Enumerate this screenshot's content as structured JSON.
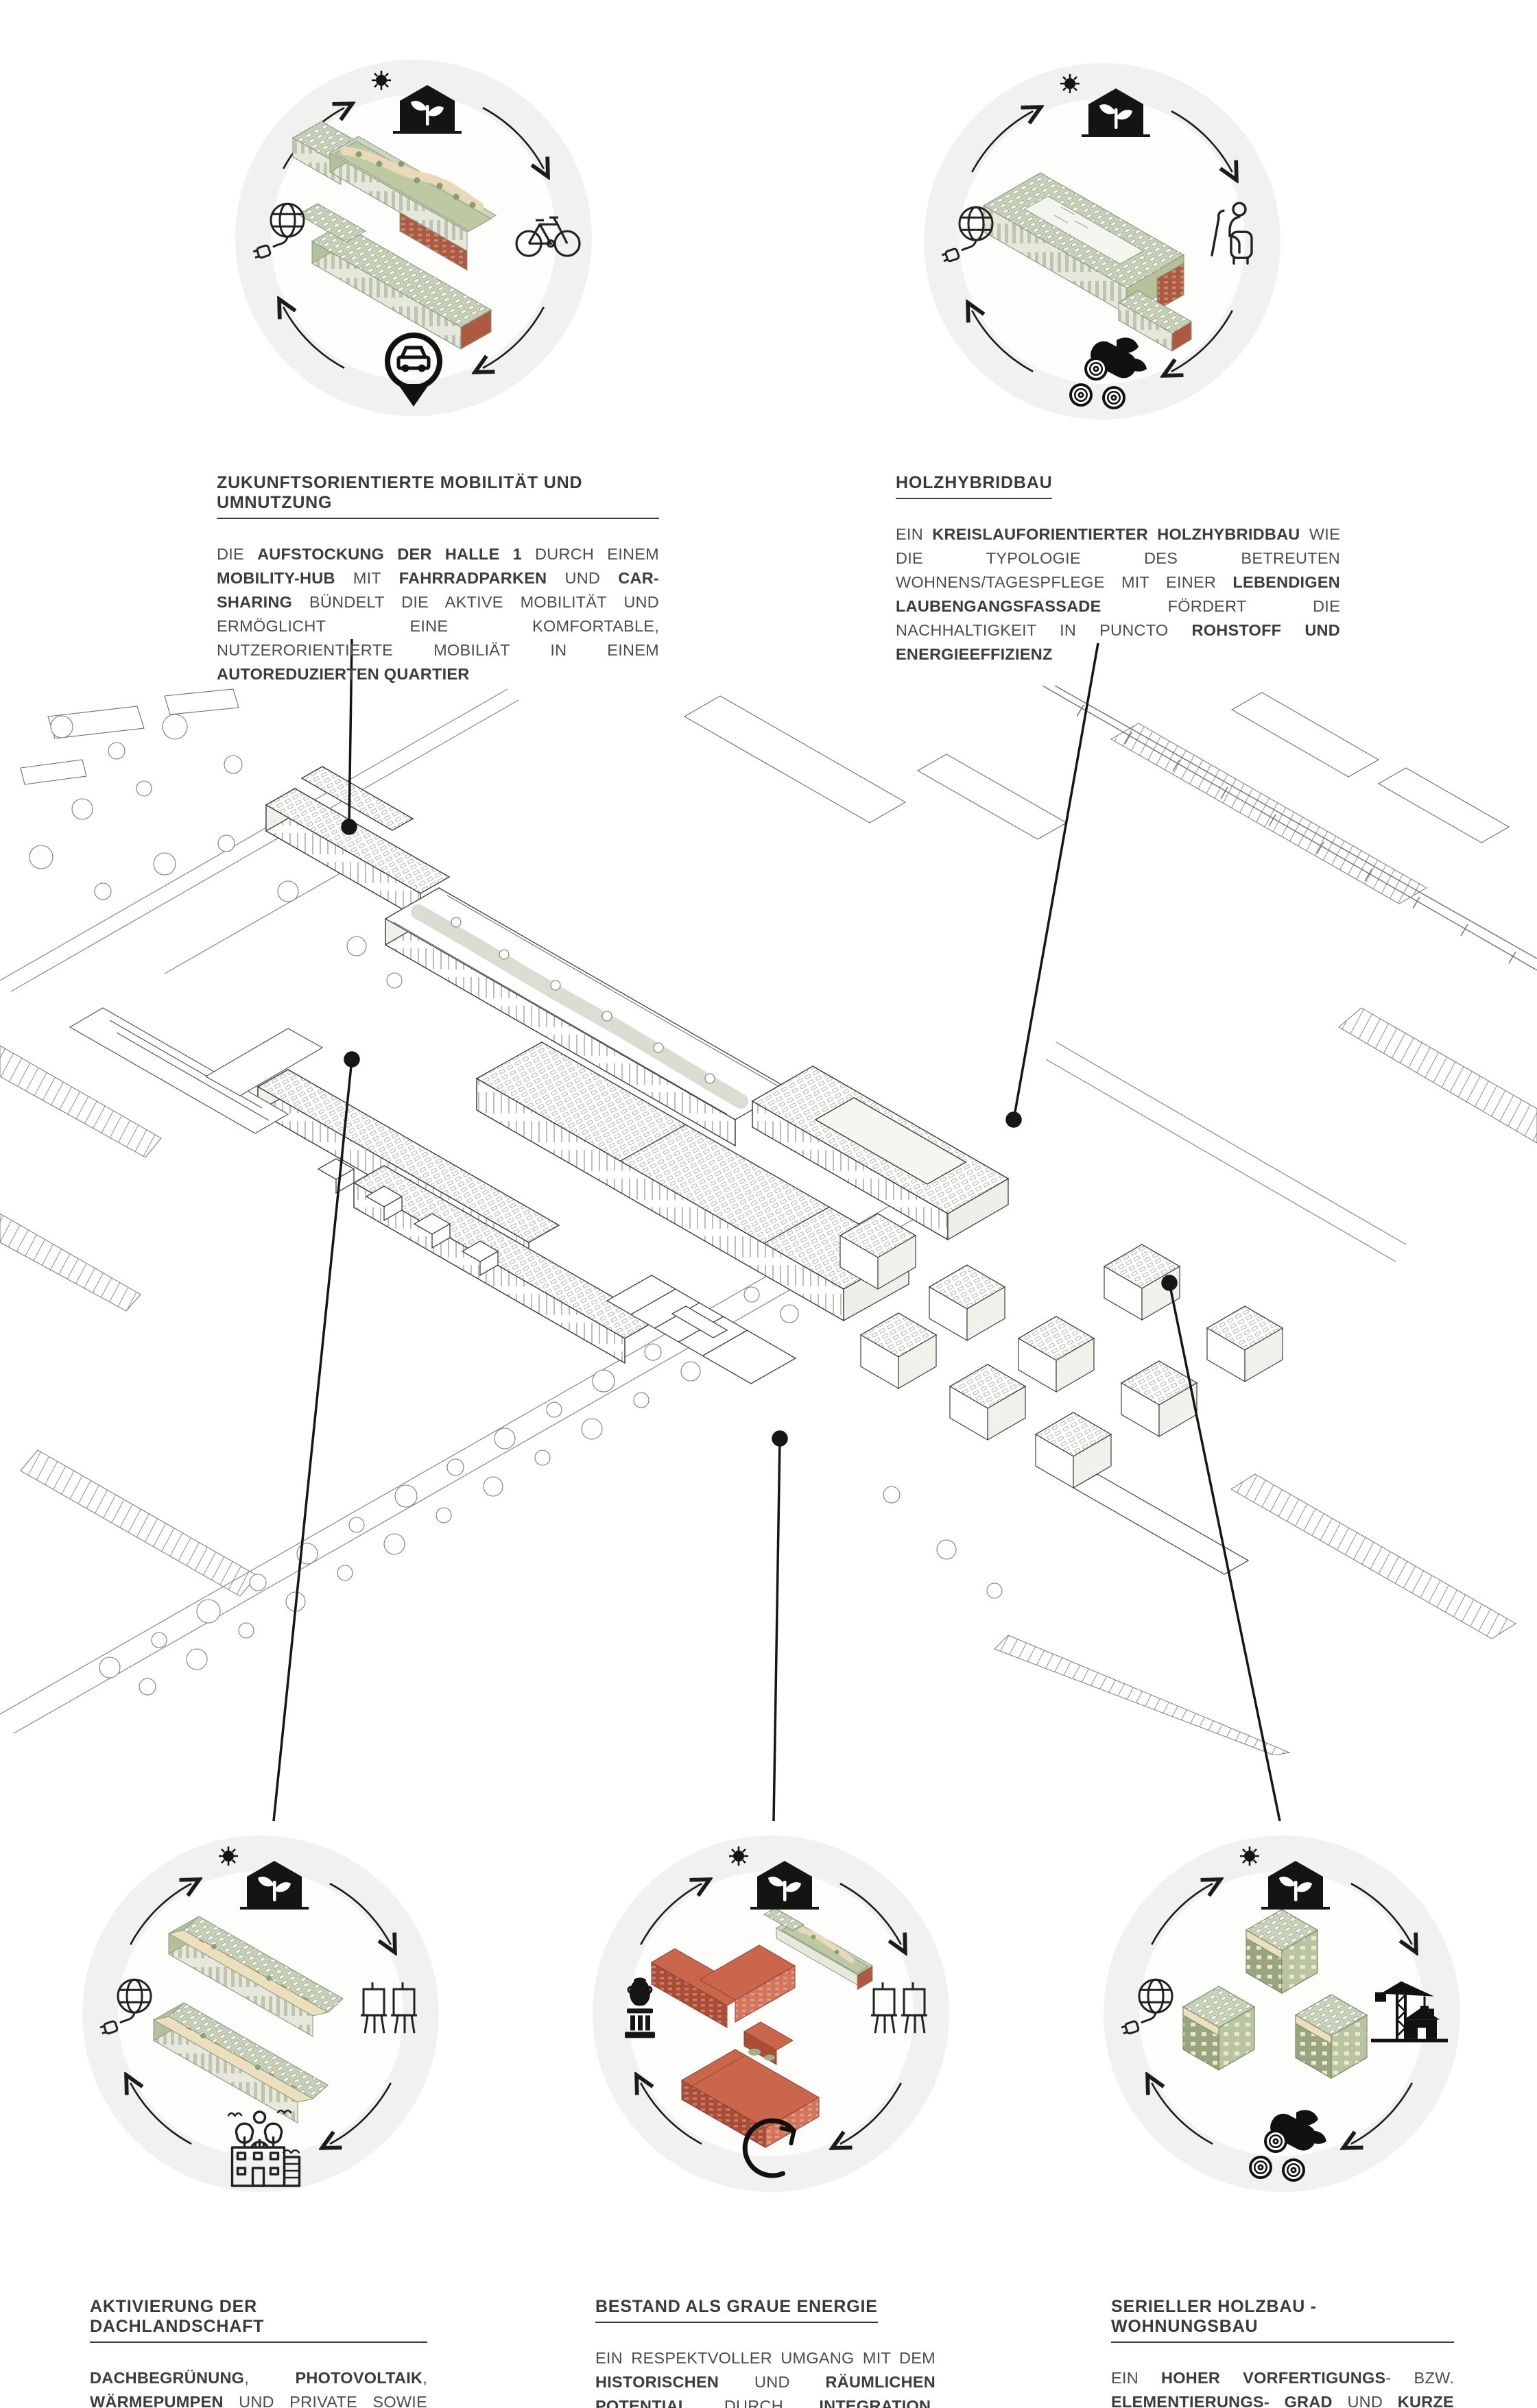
{
  "poster": {
    "colors": {
      "circle_background": "#f1f1ef",
      "line_black": "#1b1b1b",
      "pv_roof_green": "#c6d1b7",
      "landscape_roof_green": "#bcc9a3",
      "sand_path": "#ead9b9",
      "brick_red": "#ad5a41",
      "existing_building_red": "#c9664b",
      "wall_cream": "#e7e8dc",
      "text_gray": "#4c4c4c"
    },
    "sections": [
      {
        "id": "mobility",
        "title": "ZUKUNFTSORIENTIERTE MOBILITÄT UND UMNUTZUNG",
        "body": [
          {
            "t": "DIE "
          },
          {
            "t": "AUFSTOCKUNG DER HALLE 1",
            "b": true
          },
          {
            "t": " DURCH EINEM "
          },
          {
            "t": "MOBILITY-HUB",
            "b": true
          },
          {
            "t": " MIT "
          },
          {
            "t": "FAHRRADPARKEN",
            "b": true
          },
          {
            "t": " UND "
          },
          {
            "t": "CAR-SHARING",
            "b": true
          },
          {
            "t": " BÜNDELT DIE AKTIVE MOBILITÄT UND ERMÖGLICHT  EINE KOMFORTABLE, NUTZERORIENTIERTE MOBILIÄT IN EINEM "
          },
          {
            "t": "AUTOREDUZIERTEN  QUARTIER",
            "b": true
          }
        ],
        "icons": {
          "top": "eco-house-sun-icon",
          "left": "globe-plug-icon",
          "right": "bicycle-icon",
          "bottom": "car-sharing-pin-icon"
        },
        "illustration": "mobility-hub-halle1-axon"
      },
      {
        "id": "holzhybrid",
        "title": "HOLZHYBRIDBAU",
        "body": [
          {
            "t": "EIN "
          },
          {
            "t": "KREISLAUFORIENTIERTER  HOLZHYBRIDBAU",
            "b": true
          },
          {
            "t": "  WIE DIE TYPOLOGIE DES BETREUTEN WOHNENS/TAGESPFLEGE MIT EINER "
          },
          {
            "t": "LEBENDIGEN LAUBENGANGSFASSADE",
            "b": true
          },
          {
            "t": " FÖRDERT DIE NACHHALTIGKEIT IN PUNCTO "
          },
          {
            "t": "ROHSTOFF UND ENERGIEEFFIZIENZ",
            "b": true
          }
        ],
        "icons": {
          "top": "eco-house-sun-icon",
          "left": "globe-plug-icon",
          "right": "assisted-living-icon",
          "bottom": "timber-logs-icon"
        },
        "illustration": "holzhybrid-courtyard-axon"
      },
      {
        "id": "dachlandschaft",
        "title": "AKTIVIERUNG DER DACHLANDSCHAFT",
        "body": [
          {
            "t": "DACHBEGRÜNUNG",
            "b": true
          },
          {
            "t": ", "
          },
          {
            "t": "PHOTOVOLTAIK",
            "b": true
          },
          {
            "t": ", "
          },
          {
            "t": "WÄRMEPUMPEN",
            "b": true
          },
          {
            "t": " UND PRIVATE SOWIE GEMEINSCHAFTS"
          },
          {
            "t": "TERRASSEN",
            "b": true
          },
          {
            "t": " SORGEN FÜR EINE EFFIZIENTE DACHNUTZUNG, "
          },
          {
            "t": "ENERGIEGEWINNUNG",
            "b": true
          },
          {
            "t": " UND DESSEN "
          },
          {
            "t": "VERWERTUNG",
            "b": true
          }
        ],
        "icons": {
          "top": "eco-house-sun-icon",
          "left": "globe-plug-icon",
          "right": "heat-pump-icon",
          "bottom": "green-roof-community-icon"
        },
        "illustration": "roofscape-bars-axon"
      },
      {
        "id": "bestand",
        "title": "BESTAND ALS GRAUE ENERGIE",
        "body": [
          {
            "t": "EIN RESPEKTVOLLER UMGANG MIT DEM "
          },
          {
            "t": "HISTORISCHEN",
            "b": true
          },
          {
            "t": " UND "
          },
          {
            "t": "RÄUMLICHEN POTENTIAL",
            "b": true
          },
          {
            "t": " DURCH "
          },
          {
            "t": "INTEGRATION",
            "b": true
          },
          {
            "t": ", "
          },
          {
            "t": "ERHALT",
            "b": true
          },
          {
            "t": ", "
          },
          {
            "t": "WEITERBAU",
            "b": true
          },
          {
            "t": " UND "
          },
          {
            "t": "UMNUTZUNG",
            "b": true
          },
          {
            "t": " DES BESTANDES FORMT EINE SYMBIOSE MIT DEM "
          },
          {
            "t": "GENIUS LOCI",
            "b": true
          }
        ],
        "icons": {
          "top": "eco-house-sun-icon",
          "left": "historic-artifact-icon",
          "right": "heat-pump-icon",
          "bottom": "circularity-arrows-icon"
        },
        "illustration": "existing-red-buildings-axon"
      },
      {
        "id": "holzbau",
        "title": "SERIELLER HOLZBAU - WOHNUNGSBAU",
        "body": [
          {
            "t": "EIN "
          },
          {
            "t": "HOHER VORFERTIGUNGS",
            "b": true
          },
          {
            "t": "- BZW. "
          },
          {
            "t": "ELEMENTIERUNGS- GRAD",
            "b": true
          },
          {
            "t": " UND "
          },
          {
            "t": "KURZE BAUZEITEN",
            "b": true
          },
          {
            "t": " SOWIE EIN "
          },
          {
            "t": "HOHER ENERGIESTANDARD",
            "b": true
          },
          {
            "t": " SORGEN BEI DEN SÜDLICHEN WOHNTYPOLOGIEN FÜR MAXIMALE NACHHALTIGKEIT"
          }
        ],
        "icons": {
          "top": "eco-house-sun-icon",
          "left": "globe-plug-icon",
          "right": "construction-crane-icon",
          "bottom": "timber-logs-icon"
        },
        "illustration": "serial-timber-cubes-axon"
      }
    ]
  }
}
